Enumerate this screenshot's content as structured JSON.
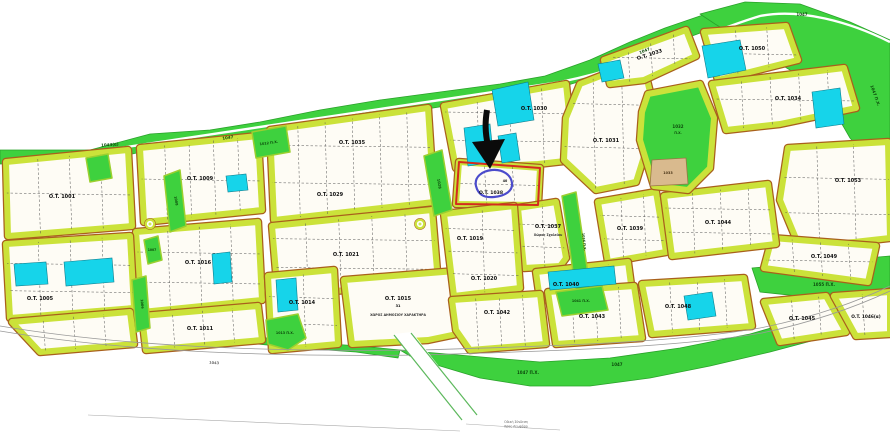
{
  "map": {
    "size": {
      "w": 890,
      "h": 440
    },
    "colors": {
      "background": "#ffffff",
      "green": "#3ed13e",
      "green_edge": "#2aa22a",
      "block_border": "#cbe23a",
      "block_border_outer": "#a9601c",
      "block_fill": "#fefcf5",
      "cyan": "#16d4ea",
      "cyan_edge": "#0f7d8c",
      "tan": "#d9ba8e",
      "tan_edge": "#9a7544",
      "highlight_red": "#d42b1f",
      "highlight_blue": "#4b4bcb",
      "arrow_black": "#0b0b0b",
      "road_gray": "#999999",
      "dash_gray": "#555555"
    },
    "green_areas_under": [
      {
        "name": "top-belt",
        "pts": "0,150 90,150 150,134 210,130 260,122 320,110 380,100 440,92 500,84 545,76 590,60 630,42 665,28 700,16 730,8 765,4 800,6 830,16 860,30 890,42 890,60 858,46 828,34 798,24 766,20 733,24 703,32 670,44 638,58 598,76 558,88 508,96 458,104 408,112 358,120 308,128 260,136 213,142 158,148 98,162 0,164"
      },
      {
        "name": "top-right-blob",
        "pts": "700,14 745,2 800,4 850,22 890,40 890,150 868,158 850,138 835,112 815,90 790,70 762,53 735,36 715,24"
      },
      {
        "name": "strip-1055",
        "pts": "752,268 890,256 890,296 836,300 760,292"
      },
      {
        "name": "bottom-belt",
        "pts": "400,350 470,356 540,362 610,358 680,348 750,334 820,314 890,290 890,322 830,336 770,352 710,366 650,378 590,386 530,386 480,378 440,366 410,356"
      },
      {
        "name": "left-sliver",
        "pts": "218,332 300,342 360,346 400,350 398,358 356,352 298,348 216,340"
      }
    ],
    "green_areas_over": [
      {
        "name": "parcel-1012",
        "pts": "252,132 286,126 290,152 256,158"
      },
      {
        "name": "parcel-left-square",
        "pts": "86,158 108,154 112,178 90,182"
      },
      {
        "name": "strip-1008",
        "pts": "164,176 180,170 186,226 170,232"
      },
      {
        "name": "parcel-1007",
        "pts": "144,240 158,236 162,260 148,264"
      },
      {
        "name": "strip-1006",
        "pts": "132,280 146,276 150,328 136,332"
      },
      {
        "name": "parcel-1013",
        "pts": "266,320 298,314 306,338 288,350 268,344"
      },
      {
        "name": "strip-1028",
        "pts": "424,156 442,150 452,210 434,216"
      },
      {
        "name": "strip-1036",
        "pts": "562,196 576,192 590,288 576,292"
      },
      {
        "name": "parcel-1041",
        "pts": "556,292 602,286 608,310 562,316"
      }
    ],
    "park": {
      "name": "park-1032",
      "pts": "648,94 700,84 714,118 710,168 688,190 654,186 640,140 642,112"
    },
    "tan_parcel": {
      "name": "parcel-1033",
      "pts": "652,160 686,158 688,184 650,186"
    },
    "blocks": [
      {
        "name": "b-1001",
        "pts": "6,162 128,150 132,226 8,236",
        "sub": [
          3,
          1
        ]
      },
      {
        "name": "b-1009",
        "pts": "140,148 258,136 262,210 144,222",
        "sub": [
          4,
          1
        ]
      },
      {
        "name": "b-1029-1035",
        "pts": "270,130 428,108 434,202 274,220",
        "sub": [
          5,
          2
        ]
      },
      {
        "name": "b-1030",
        "pts": "444,106 566,84 574,160 538,164 456,168",
        "sub": [
          3,
          2
        ]
      },
      {
        "name": "b-1038",
        "pts": "459,162 540,168 538,205 456,204",
        "sub": [
          2,
          1
        ]
      },
      {
        "name": "b-1031",
        "pts": "566,118 580,84 642,60 650,92 646,150 636,182 596,190 564,160",
        "sub": [
          2,
          2
        ]
      },
      {
        "name": "b-1033",
        "pts": "604,60 686,30 696,56 644,80 610,84",
        "sub": [
          3,
          1
        ]
      },
      {
        "name": "b-1050",
        "pts": "704,32 786,26 798,60 718,80",
        "sub": [
          2,
          1
        ]
      },
      {
        "name": "b-1034",
        "pts": "712,84 844,68 856,108 780,124 726,130",
        "sub": [
          4,
          1
        ]
      },
      {
        "name": "b-1053",
        "pts": "788,148 888,142 890,238 800,248 780,200",
        "sub": [
          2,
          2
        ]
      },
      {
        "name": "b-1049",
        "pts": "772,238 876,246 868,282 764,268",
        "sub": [
          3,
          1
        ]
      },
      {
        "name": "b-1037",
        "pts": "518,208 556,202 566,258 560,266 524,268",
        "sub": [
          1,
          2
        ]
      },
      {
        "name": "b-1039",
        "pts": "598,202 656,192 666,252 608,262",
        "sub": [
          2,
          2
        ]
      },
      {
        "name": "b-1044",
        "pts": "664,196 768,184 776,244 672,256",
        "sub": [
          3,
          2
        ]
      },
      {
        "name": "b-1040",
        "pts": "536,272 628,262 632,292 540,300",
        "sub": [
          3,
          0
        ]
      },
      {
        "name": "b-1016",
        "pts": "136,232 258,222 262,300 142,312",
        "sub": [
          3,
          2
        ]
      },
      {
        "name": "b-1021",
        "pts": "272,226 432,210 438,282 278,296",
        "sub": [
          4,
          2
        ]
      },
      {
        "name": "b-1005",
        "pts": "6,244 130,236 134,308 10,318",
        "sub": [
          3,
          2
        ]
      },
      {
        "name": "b-row4",
        "pts": "12,322 130,312 134,344 40,352",
        "sub": [
          3,
          0
        ]
      },
      {
        "name": "b-1011",
        "pts": "142,316 258,306 262,340 146,350",
        "sub": [
          3,
          0
        ]
      },
      {
        "name": "b-1014",
        "pts": "268,276 334,270 338,344 272,350",
        "sub": [
          1,
          2
        ]
      },
      {
        "name": "b-1015",
        "pts": "344,280 468,270 476,330 428,340 352,344",
        "sub": [
          0,
          0
        ]
      },
      {
        "name": "b-1019",
        "pts": "444,214 514,206 520,288 454,296",
        "sub": [
          1,
          3
        ]
      },
      {
        "name": "b-1042",
        "pts": "452,300 540,294 546,344 470,350 456,330",
        "sub": [
          3,
          0
        ]
      },
      {
        "name": "b-1043",
        "pts": "548,292 634,286 642,338 556,344",
        "sub": [
          3,
          0
        ]
      },
      {
        "name": "b-1048",
        "pts": "642,284 744,278 752,326 652,334",
        "sub": [
          3,
          0
        ]
      },
      {
        "name": "b-1045",
        "pts": "764,302 826,296 846,332 780,342",
        "sub": [
          2,
          0
        ]
      },
      {
        "name": "b-1046",
        "pts": "834,296 890,292 890,334 856,336",
        "sub": [
          1,
          0
        ]
      }
    ],
    "cyan_parcels": [
      {
        "pts": "492,90 528,82 534,120 498,126"
      },
      {
        "pts": "464,128 490,124 494,162 468,166"
      },
      {
        "pts": "498,136 516,133 520,160 502,163"
      },
      {
        "pts": "598,64 620,60 624,78 602,82"
      },
      {
        "pts": "702,46 740,40 746,70 708,78"
      },
      {
        "pts": "812,92 840,88 844,124 816,128"
      },
      {
        "pts": "226,176 246,174 248,190 228,192"
      },
      {
        "pts": "212,254 230,252 232,282 214,284"
      },
      {
        "pts": "14,264 46,262 48,284 16,286"
      },
      {
        "pts": "64,262 112,258 114,282 66,286"
      },
      {
        "pts": "276,280 296,278 298,310 278,312"
      },
      {
        "pts": "548,272 614,266 616,284 550,290"
      },
      {
        "pts": "684,296 712,292 716,316 688,320"
      }
    ],
    "roads": {
      "belt_road": "M60,157 C250,128 420,104 560,82 C640,66 700,34 760,16 C800,8 850,22 890,42",
      "bottom_road_a": "M0,326 C120,346 260,352 420,350 C560,346 680,342 760,328 C820,316 860,300 890,286",
      "bottom_road_b": "M0,331 C120,351 260,357 420,355 C560,351 680,347 762,333 C822,320 862,304 890,291",
      "access_road_fill": "394,334 412,332 478,416 462,421",
      "access_road_edge_l": "M394,335 L462,420",
      "access_road_edge_r": "M411,333 L477,415",
      "survey_line_a": "M88,415 L460,431",
      "survey_line_b": "M466,424 L560,430"
    },
    "roundabouts": [
      {
        "cx": 150,
        "cy": 224
      },
      {
        "cx": 420,
        "cy": 224
      }
    ],
    "highlight": {
      "outline_pts": "459,162 540,168 538,205 456,204",
      "blob_path": "M476,186 C474,177 482,171 492,170 C503,169 511,175 512,183 C513,191 505,196 494,197 C483,198 478,194 476,186 Z"
    },
    "arrow": {
      "shaft": "M487,110 C485,122 485,132 488,146",
      "head_pts": "472,142 505,139 490,169"
    },
    "labels": [
      {
        "t": "O.T. 1001",
        "x": 62,
        "y": 198,
        "s": 5
      },
      {
        "t": "O.T. 1009",
        "x": 200,
        "y": 180,
        "s": 5
      },
      {
        "t": "O.T. 1035",
        "x": 352,
        "y": 144,
        "s": 5
      },
      {
        "t": "O.T. 1029",
        "x": 330,
        "y": 196,
        "s": 5
      },
      {
        "t": "O.T. 1030",
        "x": 534,
        "y": 110,
        "s": 5
      },
      {
        "t": "O.T. 1031",
        "x": 606,
        "y": 142,
        "s": 5
      },
      {
        "t": "O.T. 1033",
        "x": 650,
        "y": 56,
        "s": 5,
        "r": -18
      },
      {
        "t": "O.T. 1050",
        "x": 752,
        "y": 50,
        "s": 5
      },
      {
        "t": "O.T. 1034",
        "x": 788,
        "y": 100,
        "s": 5
      },
      {
        "t": "O.T. 1053",
        "x": 848,
        "y": 182,
        "s": 5
      },
      {
        "t": "O.T. 1049",
        "x": 824,
        "y": 258,
        "s": 5
      },
      {
        "t": "O.T. 1037",
        "x": 548,
        "y": 228,
        "s": 5
      },
      {
        "t": "Χώρος Σχολείου",
        "x": 548,
        "y": 236,
        "s": 3.2,
        "c": "#333333"
      },
      {
        "t": "O.T. 1039",
        "x": 630,
        "y": 230,
        "s": 5
      },
      {
        "t": "O.T. 1044",
        "x": 718,
        "y": 224,
        "s": 5
      },
      {
        "t": "O.T. 1040",
        "x": 566,
        "y": 286,
        "s": 5
      },
      {
        "t": "O.T. 1016",
        "x": 198,
        "y": 264,
        "s": 5
      },
      {
        "t": "O.T. 1021",
        "x": 346,
        "y": 256,
        "s": 5
      },
      {
        "t": "O.T. 1005",
        "x": 40,
        "y": 300,
        "s": 5
      },
      {
        "t": "O.T. 1011",
        "x": 200,
        "y": 330,
        "s": 5
      },
      {
        "t": "O.T. 1014",
        "x": 302,
        "y": 304,
        "s": 5
      },
      {
        "t": "O.T. 1015",
        "x": 398,
        "y": 300,
        "s": 5
      },
      {
        "t": "31",
        "x": 398,
        "y": 307,
        "s": 3.5
      },
      {
        "t": "ΧΩΡΟΣ ΔΗΜΟΣΙΟΥ ΧΑΡΑΚΤΗΡΑ",
        "x": 398,
        "y": 316,
        "s": 3.2,
        "c": "#333333"
      },
      {
        "t": "O.T. 1019",
        "x": 470,
        "y": 240,
        "s": 5
      },
      {
        "t": "O.T. 1020",
        "x": 484,
        "y": 280,
        "s": 5
      },
      {
        "t": "O.T. 1042",
        "x": 497,
        "y": 314,
        "s": 5
      },
      {
        "t": "O.T. 1043",
        "x": 592,
        "y": 318,
        "s": 5
      },
      {
        "t": "O.T. 1048",
        "x": 678,
        "y": 308,
        "s": 5
      },
      {
        "t": "O.T. 1045",
        "x": 802,
        "y": 320,
        "s": 5
      },
      {
        "t": "O.T. 1046(α)",
        "x": 866,
        "y": 318,
        "s": 4.3
      },
      {
        "t": "O.T. 1038",
        "x": 491,
        "y": 194,
        "s": 4.6
      },
      {
        "t": "40",
        "x": 505,
        "y": 182,
        "s": 3.2
      },
      {
        "t": "1043(α)",
        "x": 110,
        "y": 146,
        "s": 4,
        "r": -4,
        "c": "#0c4a0c"
      },
      {
        "t": "1047",
        "x": 228,
        "y": 139,
        "s": 4,
        "r": -8,
        "c": "#0c4a0c"
      },
      {
        "t": "1047",
        "x": 645,
        "y": 52,
        "s": 4,
        "r": -22,
        "c": "#0c4a0c"
      },
      {
        "t": "1047",
        "x": 802,
        "y": 16,
        "s": 4,
        "c": "#0c4a0c"
      },
      {
        "t": "1047 Π.Χ.",
        "x": 874,
        "y": 96,
        "s": 4,
        "r": 70,
        "c": "#0c4a0c"
      },
      {
        "t": "1047 Π.Χ.",
        "x": 528,
        "y": 374,
        "s": 4,
        "c": "#0c4a0c"
      },
      {
        "t": "1047",
        "x": 617,
        "y": 366,
        "s": 4,
        "c": "#0c4a0c"
      },
      {
        "t": "1055 Π.Χ.",
        "x": 824,
        "y": 286,
        "s": 4,
        "c": "#0c4a0c"
      },
      {
        "t": "1032",
        "x": 678,
        "y": 128,
        "s": 4,
        "c": "#0c4a0c"
      },
      {
        "t": "Π.Χ.",
        "x": 678,
        "y": 134,
        "s": 3.2,
        "c": "#0c4a0c"
      },
      {
        "t": "1033",
        "x": 668,
        "y": 174,
        "s": 3.4,
        "c": "#4a3517"
      },
      {
        "t": "1012 Π.Χ.",
        "x": 269,
        "y": 144,
        "s": 3.4,
        "r": -8,
        "c": "#0c4a0c"
      },
      {
        "t": "1008",
        "x": 175,
        "y": 201,
        "s": 3.4,
        "r": 80,
        "c": "#0c4a0c"
      },
      {
        "t": "1007",
        "x": 152,
        "y": 251,
        "s": 3.1,
        "c": "#0c4a0c"
      },
      {
        "t": "1006",
        "x": 141,
        "y": 304,
        "s": 3.4,
        "r": 85,
        "c": "#0c4a0c"
      },
      {
        "t": "1013 Π.Χ.",
        "x": 285,
        "y": 334,
        "s": 3.3,
        "c": "#0c4a0c"
      },
      {
        "t": "1028",
        "x": 438,
        "y": 184,
        "s": 3.6,
        "r": 80,
        "c": "#0c4a0c"
      },
      {
        "t": "1036 Π.Χ.",
        "x": 583,
        "y": 242,
        "s": 3.3,
        "r": 84,
        "c": "#0c4a0c"
      },
      {
        "t": "1041 Π.Χ.",
        "x": 581,
        "y": 302,
        "s": 3.3,
        "c": "#0c4a0c"
      },
      {
        "t": "1043",
        "x": 214,
        "y": 364,
        "s": 3.6,
        "r": 4,
        "c": "#666666"
      }
    ],
    "road_note": {
      "lines": [
        "Οδική Σύνδεση",
        "προς Λεωφόρο"
      ],
      "x": 516,
      "y": 423,
      "s": 3.2,
      "c": "#666666"
    }
  }
}
